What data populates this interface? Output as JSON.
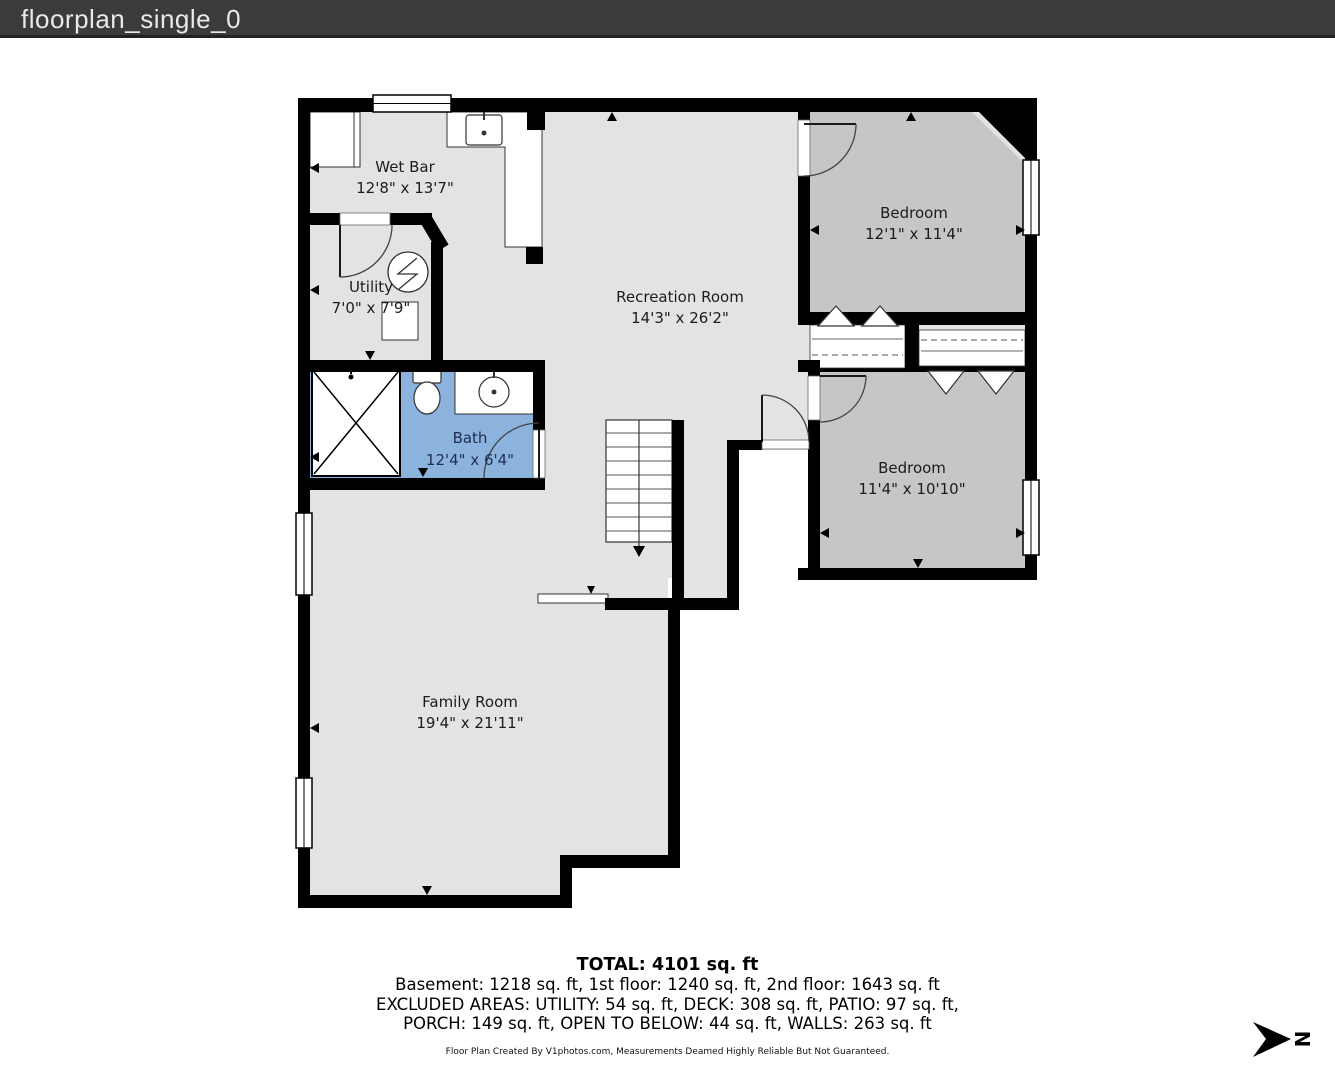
{
  "header": {
    "title": "floorplan_single_0"
  },
  "rooms": [
    {
      "id": "wet-bar",
      "name": "Wet Bar",
      "dims": "12'8\" x 13'7\""
    },
    {
      "id": "utility",
      "name": "Utility",
      "dims": "7'0\" x 7'9\""
    },
    {
      "id": "recreation",
      "name": "Recreation Room",
      "dims": "14'3\" x 26'2\""
    },
    {
      "id": "bedroom-1",
      "name": "Bedroom",
      "dims": "12'1\" x 11'4\""
    },
    {
      "id": "bath",
      "name": "Bath",
      "dims": "12'4\" x 6'4\""
    },
    {
      "id": "bedroom-2",
      "name": "Bedroom",
      "dims": "11'4\" x 10'10\""
    },
    {
      "id": "family",
      "name": "Family Room",
      "dims": "19'4\" x 21'11\""
    }
  ],
  "summary": {
    "total": "TOTAL: 4101 sq. ft",
    "line1": "Basement: 1218 sq. ft, 1st floor: 1240 sq. ft, 2nd floor: 1643 sq. ft",
    "line2": "EXCLUDED AREAS: UTILITY: 54 sq. ft, DECK: 308 sq. ft, PATIO: 97 sq. ft,",
    "line3": "PORCH: 149 sq. ft, OPEN TO BELOW: 44 sq. ft, WALLS: 263 sq. ft"
  },
  "footer": {
    "credit": "Floor Plan Created By V1photos.com, Measurements Deamed Highly Reliable But Not Guaranteed."
  },
  "compass": {
    "label": "N"
  },
  "colors": {
    "header_bg": "#3b3b3b",
    "floor": "#e3e3e3",
    "bedroom_floor": "#c6c6c6",
    "bath_floor": "#8cb3de",
    "wall": "#000000"
  },
  "icons": {
    "compass": "north-arrow",
    "stairs": "stairs-down-arrow",
    "shower": "x-square",
    "water_heater": "zigzag-circle",
    "sink": "basin-circle"
  }
}
